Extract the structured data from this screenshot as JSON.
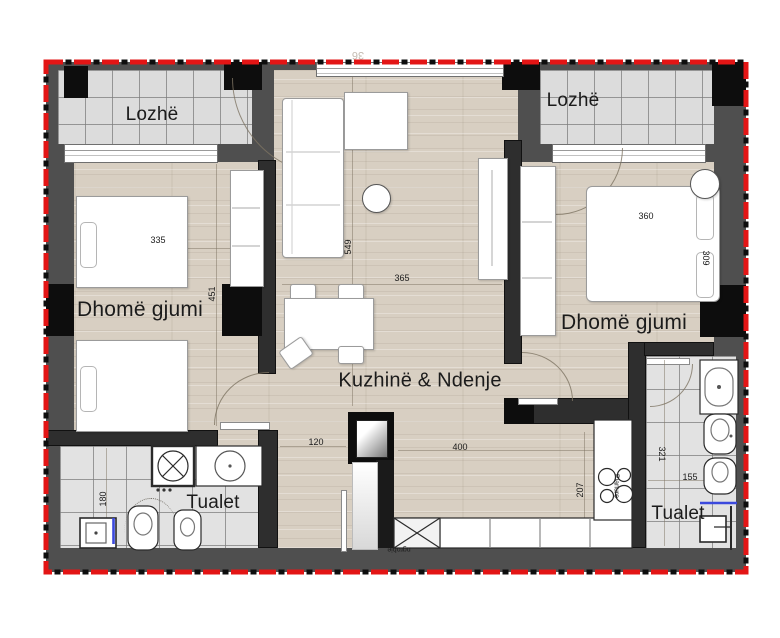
{
  "plan": {
    "title": "apartment-floor-plan",
    "rooms": [
      {
        "id": "lozhe-left",
        "label": "Lozhë",
        "x": 152,
        "y": 115,
        "size": 19
      },
      {
        "id": "lozhe-right",
        "label": "Lozhë",
        "x": 573,
        "y": 101,
        "size": 19
      },
      {
        "id": "bedroom-left",
        "label": "Dhomë gjumi",
        "x": 140,
        "y": 310,
        "size": 21
      },
      {
        "id": "living-kitchen",
        "label": "Kuzhinë & Ndenje",
        "x": 420,
        "y": 381,
        "size": 20
      },
      {
        "id": "bedroom-right",
        "label": "Dhomë gjumi",
        "x": 624,
        "y": 323,
        "size": 21
      },
      {
        "id": "toilet-left",
        "label": "Tualet",
        "x": 213,
        "y": 503,
        "size": 19
      },
      {
        "id": "toilet-right",
        "label": "Tualet",
        "x": 678,
        "y": 514,
        "size": 19
      }
    ],
    "dimensions": [
      {
        "value": "335",
        "x": 158,
        "y": 240,
        "rot": 0
      },
      {
        "value": "451",
        "x": 212,
        "y": 294,
        "rot": -90
      },
      {
        "value": "549",
        "x": 348,
        "y": 247,
        "rot": -90
      },
      {
        "value": "365",
        "x": 402,
        "y": 278,
        "rot": 0
      },
      {
        "value": "120",
        "x": 316,
        "y": 442,
        "rot": 0
      },
      {
        "value": "400",
        "x": 460,
        "y": 447,
        "rot": 0
      },
      {
        "value": "360",
        "x": 646,
        "y": 216,
        "rot": 0
      },
      {
        "value": "309",
        "x": 706,
        "y": 258,
        "rot": 90
      },
      {
        "value": "207",
        "x": 580,
        "y": 490,
        "rot": -90
      },
      {
        "value": "321",
        "x": 662,
        "y": 454,
        "rot": 90
      },
      {
        "value": "155",
        "x": 690,
        "y": 477,
        "rot": 0
      },
      {
        "value": "180",
        "x": 103,
        "y": 499,
        "rot": -90
      }
    ],
    "annotations": [
      {
        "id": "ngrohje",
        "value": "ngrohje",
        "x": 399,
        "y": 549,
        "rot": 180,
        "size": 7
      },
      {
        "id": "pianure",
        "value": "Pianure",
        "x": 616,
        "y": 486,
        "rot": 90,
        "size": 7
      },
      {
        "id": "top-dim",
        "value": "36",
        "x": 358,
        "y": 55,
        "rot": 180,
        "size": 11,
        "color": "#c4bcb2"
      }
    ]
  },
  "colors": {
    "boundary_red": "#e31515",
    "wall_gray": "#4f4f4f",
    "wall_dark": "#2e2e2e",
    "column_black": "#0d0d0d",
    "wood_floor": "#d8cfc2",
    "tile_floor": "#dcdcdc",
    "shower_glass_blue": "#3b49dd"
  }
}
